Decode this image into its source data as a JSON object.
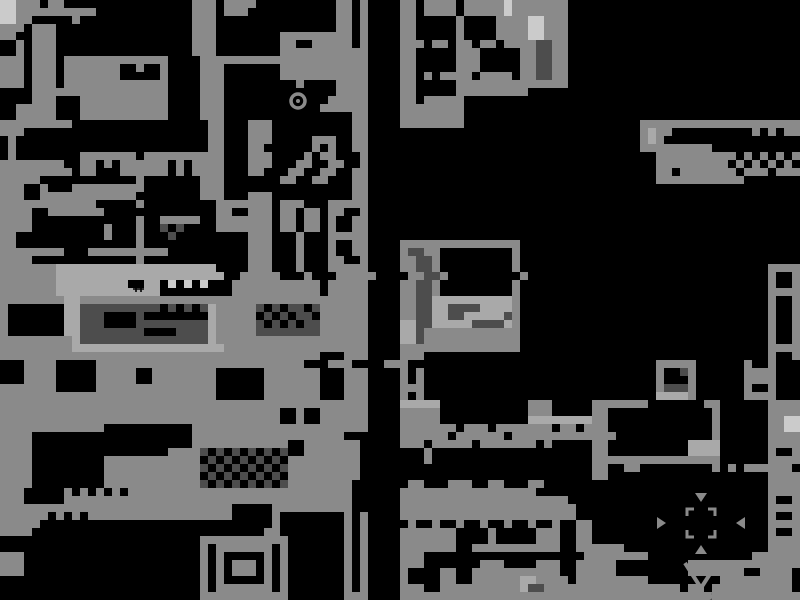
{
  "map": {
    "width": 800,
    "height": 600,
    "cell_size": 8,
    "background": "#000000",
    "palette": {
      "g": "#8a8a8a",
      "d": "#4d4d4d",
      "l": "#a9a9a9",
      "w": "#cbcbcb",
      ".": "#000000"
    },
    "legend": {
      "g": "terrain-gray",
      "d": "machinery-dark-gray",
      "l": "room-light-gray",
      "w": "highlight-near-white",
      ".": "void-black"
    },
    "grid": [
      "wwggg.gg................ggg.gggg..........gg.g....gg.gggg.gggggwggggggg.............................",
      "wwgggggggggg............ggg.ggg...........gg.g....gg.gggg.gggggwggggggg.............................",
      "wwgg.....g..............ggg...............gg.g....gg.....g....ggggwwggg.............................",
      "ggg.ggg.................ggg...............gg.g....gg.....g....ggggwwggg.............................",
      "gg..ggg.................ggg........ggggggggg.g....gg.....g....ggggwwggg.............................",
      "..g.ggg.................ggg........gg..ggggg.g....ggg.gg.gg.gg.ggggddgg.............................",
      "..g.ggg.................ggg........ggggggggggg....gg.....ggg.....ggddgg.............................",
      "ggg.ggg.ggggggggggggg....ggggggggggggggggggggg....gg.....ggg.....ggddgg.............................",
      "ggg.ggg.ggggggg..g..g....ggg.......ggggggggggg....gg.....ggg.....ggddgg.............................",
      "ggg.ggg.ggggggg.....g....ggg.......ggggggggggg....gg.g.gggg.gggg.ggddgg.............................",
      "ggg.ggg.ggggggggggggg....ggg.........g....gggg....gg.....gggggggggggggg.............................",
      "....ggggggggggggggggg....ggg..............gggg....gg.....ggggggggg..................................",
      "....ggg...ggggggggggg....ggg.............ggggg....gg.ggggg..........................................",
      "..ggggg...ggggggggggg....ggg............gggggg....gggggggg..........................................",
      "..ggggg...ggggggggggg....ggg................gg....gggggggg..........................................",
      "ggggggggg.................gg...ggg..........gg....gggggggg......................gggggggggggggggggggg",
      "ggg.......................gg...ggg..........gg..................................glgg..........g.g.gg",
      ".g........................gg...ggg.....ggg..gg..................................glg.................",
      ".g........................gg...gg......g.g..gg..................................ggggggggg...........",
      ".g........ggggggg.gggggggggg...ggg....g.gg...g....................................gggggggggg.g.g.g.g",
      "gggggggg..gg.g.gggggg.g.gggg...ggg...gg..gg..g....................................ggggggggg.g.g.g.g.",
      "ggggggggg.gg...gggggg.g.gggg...gg...gg..gg..gg....................................gg.ggggggg.ggg.ggg",
      "ggggg............g.......ggg.......gg..gg...gg....................................ggggggggggg........",
      "ggg..g...ggggggggg.......ggg................gg......................................................",
      "ggg..gggggggggggg........ggg...ggg..........gg......................................................",
      "gggggggggggg.....g.........ggggggg.ggg...ggggg......................................................",
      "gggg..ggggggg..............gg..ggg.gg.gg.gg..g......................................................",
      "gggg.............g..ggggg..ggggggg.gg.gg.g..gg......................................................",
      "gggg.........g...g..d.d....ggggggg.gg.gg.g..gg......................................................",
      "gg...........g...g...d.........ggg...g...ggggg......................................................",
      "gg...............g.............ggg...g...g..gg....ggggggggggggggg...................................",
      "gggggggg...gggggggggg..........ggg...g...g..gg....gddgg.........g...................................",
      "gggg.............g.............ggg...g...gg..g....ggddg.........g...................................",
      "gggggggllllllllllllllllllll....ggg...g...ggggg....ggddg.........g...............................gggg",
      "ggggggglllllllllllllllllllll..ggggg...g...ggggg....ggddg.........g..............................g..g",
      "ggggggglllllllll..ll.w.w.w...ggggggggggg.ggggg....ggddg.........g...............................g..g",
      "ggggggglllllllllllll.........ggggggggggg.ggggg....ggddg.........g...............................gggg",
      "ggggggggllgggggggggggggggggggggggggggggggggggg....ggddllllllllllg...............................g..g",
      "g.......lldddddddddd.d.d.dlgggggd.d.dd.dgggggg....ggddllddddllllg...............................g..g",
      "g.......llddd....d........lggggg.d.d.dd.gggggg....ggddlldDlllllDg...............................g..g",
      "g.......llddd....dddddddddlgggggd.d.d.ddgggggg....lldDlllllddddlg...............................g..g",
      "g.......lldddddddd....ddddlgggggddddddddgggggg....lldgggggggggggg...............................g..g",
      "gggggggggldddddddddddddddd",
      "ggggggggglllllllllllllllllllgggggggggggggggggg....ggggggggggggggg...............................gggg",
      "gggggggggggggggggggggggggggggggggggggggg...ggg....ggg...........................................g..g",
      "...gggg.....gggggggggggggggggggggggggg...ggg....ggg...............................ggggg......g..g",
      "...gggg.....ggggg..gggggggg......ggggggg...ggg....g.g.............................g..dg......gggg",
      "...gggg.....ggggg..gggggggg......ggggggg...ggg....g.g.............................g...g......gggg",
      "ggggggg.....ggggggggggggggg......ggggggg...ggg....ggg.............................gdddg......g..g",
      "ggggggggggggggggggggggggggg......ggggggg...ggg....g.g.............................llllg......gggg",
      "gggggggggggggggggggggggggggggggggggggggggggggg....lllll...........ggg.....ggggggg.......gg......gggg",
      "ggggggggggggggggggggggggggggggggggg..g..gggggg....ggggg...........ggg.....gg.............g......gggg",
      "ggggggggggggggggggggggggggggggggggg..g..gggggg....ggggg...........llllllllgg.............g......ggww",
      "ggggggggggggg...........gggggggggggggggggggggg....ggggggg.ggg.ggggggg.gg.ggg.............g......ggww",
      "gggg....................ggggggggggggggggggg.......gggggg.gggggg.ggggggggggggg............g......gggg",
      "gggg....................gggggggggggg..ggggggg.....ggg.ggggg.ggggggg.g.....gg..........llll......gggg",
      "gggg.................ggggd.d.d.d.d.d..ggggggg........g....................gg..........llll......g..g",
      "gggg.........gggggggggggg.d.d.d.d.d.ggggggggg........g....................gggggggggggggggg......gggg",
      "gggg.........ggggggggggggd.d.d.d.d.dggggggggg.............................gg..gg.........g.g.gggggg",
      "gggg.........gggggggggggg.d.d.d.d.d.ggggggggg.............................gg....................gggg",
      "gggg.........ggggggggggggd.d.d.d.d.dgggggggg.......gg...ggg..gg...gg............................gggg",
      "ggg.....g.g.g.g.gggggggggggggggggggggggggggg......ggggggggggggggggg.............................gggg",
      "ggg.....gggggggggggggggggggggggggggggggggggg......ggggggggggggggggggggg.........................g..g",
      "ggggggggggggggggggggggggggggg.....gggggggggg......gggggggggggggggggggggg........................gggg",
      "gggggg.g.g.gggggggggggggggggg.....g........g.g....gggggggggggggggggggggg........................g..g",
      "ggggg.............................g........g.g.....g..g..g..g..g..g..g..gg......................gggg",
      "gggg.............................gg........g.g....ggggggg....g.....ggg..gg......................g..g",
      ".........................ggggggggggg.......g.g....ggggggg....g.....ggg..gg......................gggg",
      ".........................g.ggggggg.g.......g.g....ggggggg..ggggggggggg..gggggg..................gggg",
      "ggg......................g.g.....g.g.......g.g....ggg....................gggggggg.............gggggg",
      "ggg......................g.g.ggg.g.g.......g.g....ggg.......ggg....ggg..ggggg.........gggggggggggggg",
      "ggg......................g.g.ggg.g.g.......g.g....g....gg..ggggggggggg..ggggg.........ggggggg..gggg",
      ".........................g.g.....g.g.......g.g....g....gg..ggggggllgggg.ggggggggg.........ggggggggg",
      ".........................g.ggggggg.g.......g.g....ggg..gggggggggglddggggggggggggggggg.gg.gggggggggg",
      ".........................ggggggggggg.......ggg....gggggggggggggggggggggggggggggggggggggddggggggggggg"
    ],
    "grid_note": "row 42 continues",
    "grid_row42_tail": "lggggggggggggggggggg....lldgggggggggggg...............................g..g"
  },
  "landmarks": [
    {
      "name": "shelter-ring",
      "type": "ring",
      "x": 298,
      "y": 101
    },
    {
      "name": "water-droplet",
      "type": "droplet",
      "x": 140,
      "y": 251
    },
    {
      "name": "hash-marker",
      "type": "hash",
      "x": 139,
      "y": 287
    },
    {
      "name": "gate-arrow-top",
      "type": "tri-down",
      "x": 701,
      "y": 497
    },
    {
      "name": "gate-arrow-left",
      "type": "tri-right",
      "x": 661,
      "y": 523
    },
    {
      "name": "gate-arrow-right",
      "type": "tri-left",
      "x": 741,
      "y": 523
    },
    {
      "name": "gate-arrow-bottom",
      "type": "tri-up",
      "x": 701,
      "y": 550
    },
    {
      "name": "gate-bracket",
      "type": "bracket",
      "x": 701,
      "y": 523
    },
    {
      "name": "gate-chevron",
      "type": "chevron",
      "x": 701,
      "y": 575
    },
    {
      "name": "gate-bowl",
      "type": "bowl",
      "x": 701,
      "y": 594
    }
  ]
}
